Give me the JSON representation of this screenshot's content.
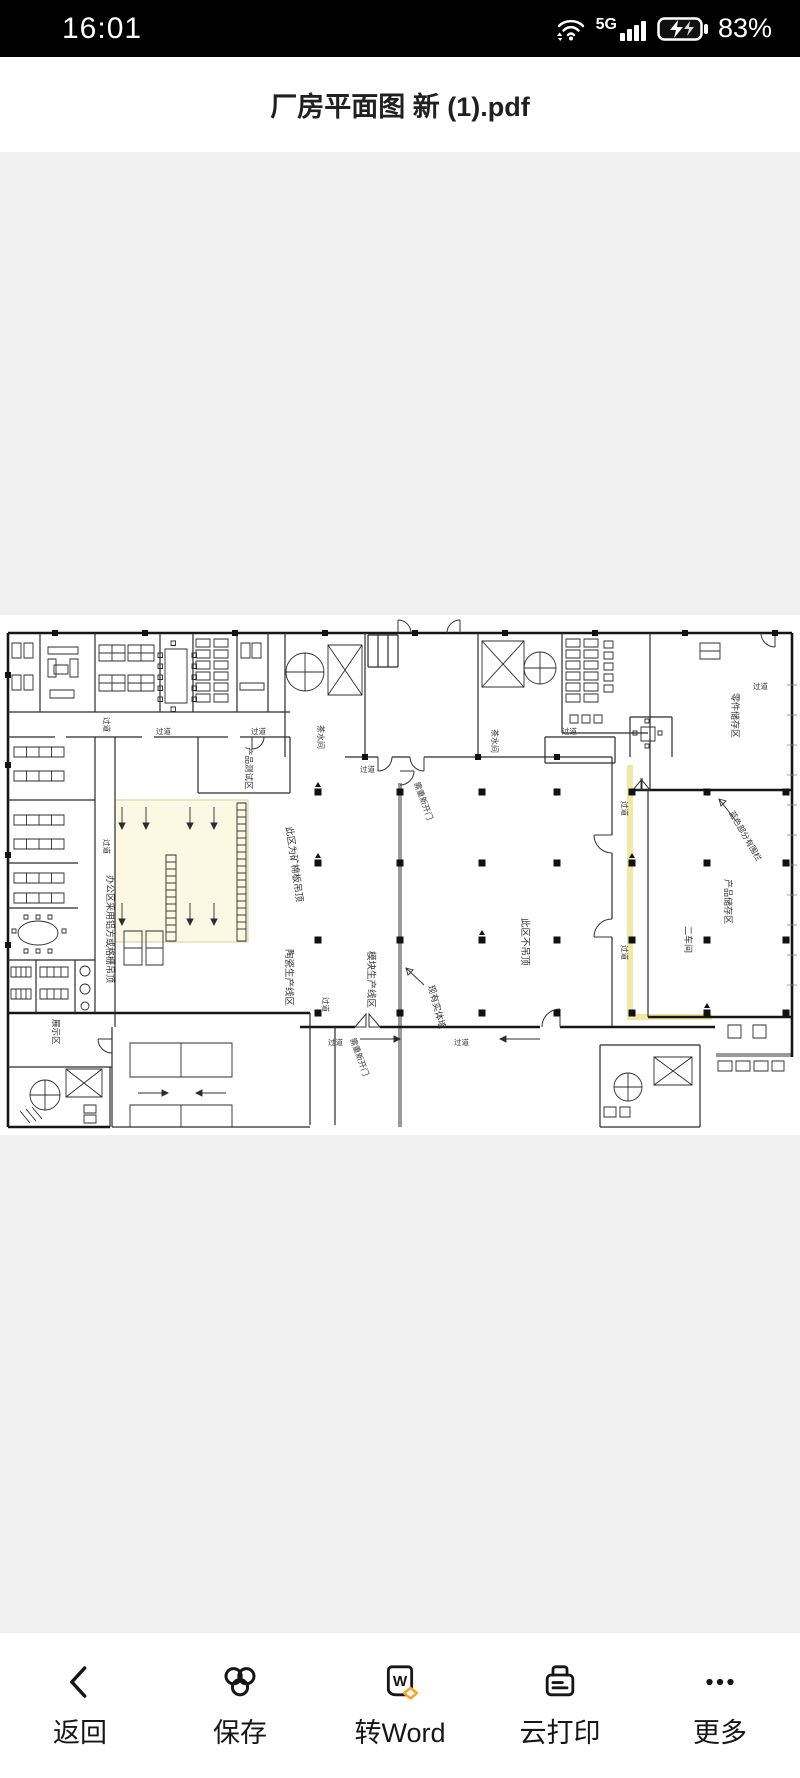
{
  "status_bar": {
    "time": "16:01",
    "network": "5G",
    "battery_percent": "83%"
  },
  "title_bar": {
    "filename": "厂房平面图 新 (1).pdf"
  },
  "viewer": {
    "background": "#f1f1f2",
    "page_background": "#ffffff",
    "highlight_color": "#f0e9a6"
  },
  "floor_plan": {
    "labels": [
      {
        "text": "过道",
        "x": 156,
        "y": 119,
        "r": 0,
        "s": 7.5
      },
      {
        "text": "过道",
        "x": 251,
        "y": 119,
        "r": 0,
        "s": 7.5
      },
      {
        "text": "过道",
        "x": 562,
        "y": 119,
        "r": 0,
        "s": 7.5
      },
      {
        "text": "过道",
        "x": 753,
        "y": 74,
        "r": 0,
        "s": 7.5
      },
      {
        "text": "过道",
        "x": 360,
        "y": 157,
        "r": 0,
        "s": 7.5
      },
      {
        "text": "过道",
        "x": 104,
        "y": 102,
        "r": 90,
        "s": 7.5
      },
      {
        "text": "过道",
        "x": 104,
        "y": 224,
        "r": 90,
        "s": 7.5
      },
      {
        "text": "产品测试区",
        "x": 246,
        "y": 132,
        "r": 90,
        "s": 8.5
      },
      {
        "text": "茶水间",
        "x": 318,
        "y": 110,
        "r": 90,
        "s": 8
      },
      {
        "text": "茶水间",
        "x": 492,
        "y": 114,
        "r": 90,
        "s": 8
      },
      {
        "text": "需重新开门",
        "x": 414,
        "y": 168,
        "r": 70,
        "s": 8
      },
      {
        "text": "此区为矿棉板吊顶",
        "x": 286,
        "y": 212,
        "r": 82,
        "s": 9.5
      },
      {
        "text": "陶瓷生产线区",
        "x": 286,
        "y": 334,
        "r": 90,
        "s": 9.5
      },
      {
        "text": "模块生产线区",
        "x": 368,
        "y": 336,
        "r": 90,
        "s": 9.5
      },
      {
        "text": "现有实体墙",
        "x": 428,
        "y": 371,
        "r": 75,
        "s": 9
      },
      {
        "text": "此区不吊顶",
        "x": 522,
        "y": 303,
        "r": 90,
        "s": 9.5
      },
      {
        "text": "二车间",
        "x": 685,
        "y": 311,
        "r": 90,
        "s": 9
      },
      {
        "text": "零件储存区",
        "x": 732,
        "y": 78,
        "r": 90,
        "s": 9
      },
      {
        "text": "蓝色部分有围栏",
        "x": 729,
        "y": 198,
        "r": 60,
        "s": 8
      },
      {
        "text": "产品储存区",
        "x": 725,
        "y": 264,
        "r": 90,
        "s": 9
      },
      {
        "text": "办公区采用铝方或格栅吊顶",
        "x": 107,
        "y": 260,
        "r": 90,
        "s": 9
      },
      {
        "text": "展示区",
        "x": 53,
        "y": 404,
        "r": 90,
        "s": 8.5
      },
      {
        "text": "过道",
        "x": 622,
        "y": 186,
        "r": 90,
        "s": 7.5
      },
      {
        "text": "过道",
        "x": 622,
        "y": 330,
        "r": 90,
        "s": 7.5
      },
      {
        "text": "过道",
        "x": 323,
        "y": 382,
        "r": 90,
        "s": 7.5
      },
      {
        "text": "过道",
        "x": 328,
        "y": 430,
        "r": 0,
        "s": 7.5
      },
      {
        "text": "过道",
        "x": 454,
        "y": 430,
        "r": 0,
        "s": 7.5
      },
      {
        "text": "需重新开门",
        "x": 350,
        "y": 424,
        "r": 70,
        "s": 8
      }
    ]
  },
  "toolbar": {
    "accent": "#F5A623",
    "items": [
      {
        "label": "返回"
      },
      {
        "label": "保存"
      },
      {
        "label": "转Word",
        "icon_letter": "W"
      },
      {
        "label": "云打印"
      },
      {
        "label": "更多"
      }
    ]
  }
}
